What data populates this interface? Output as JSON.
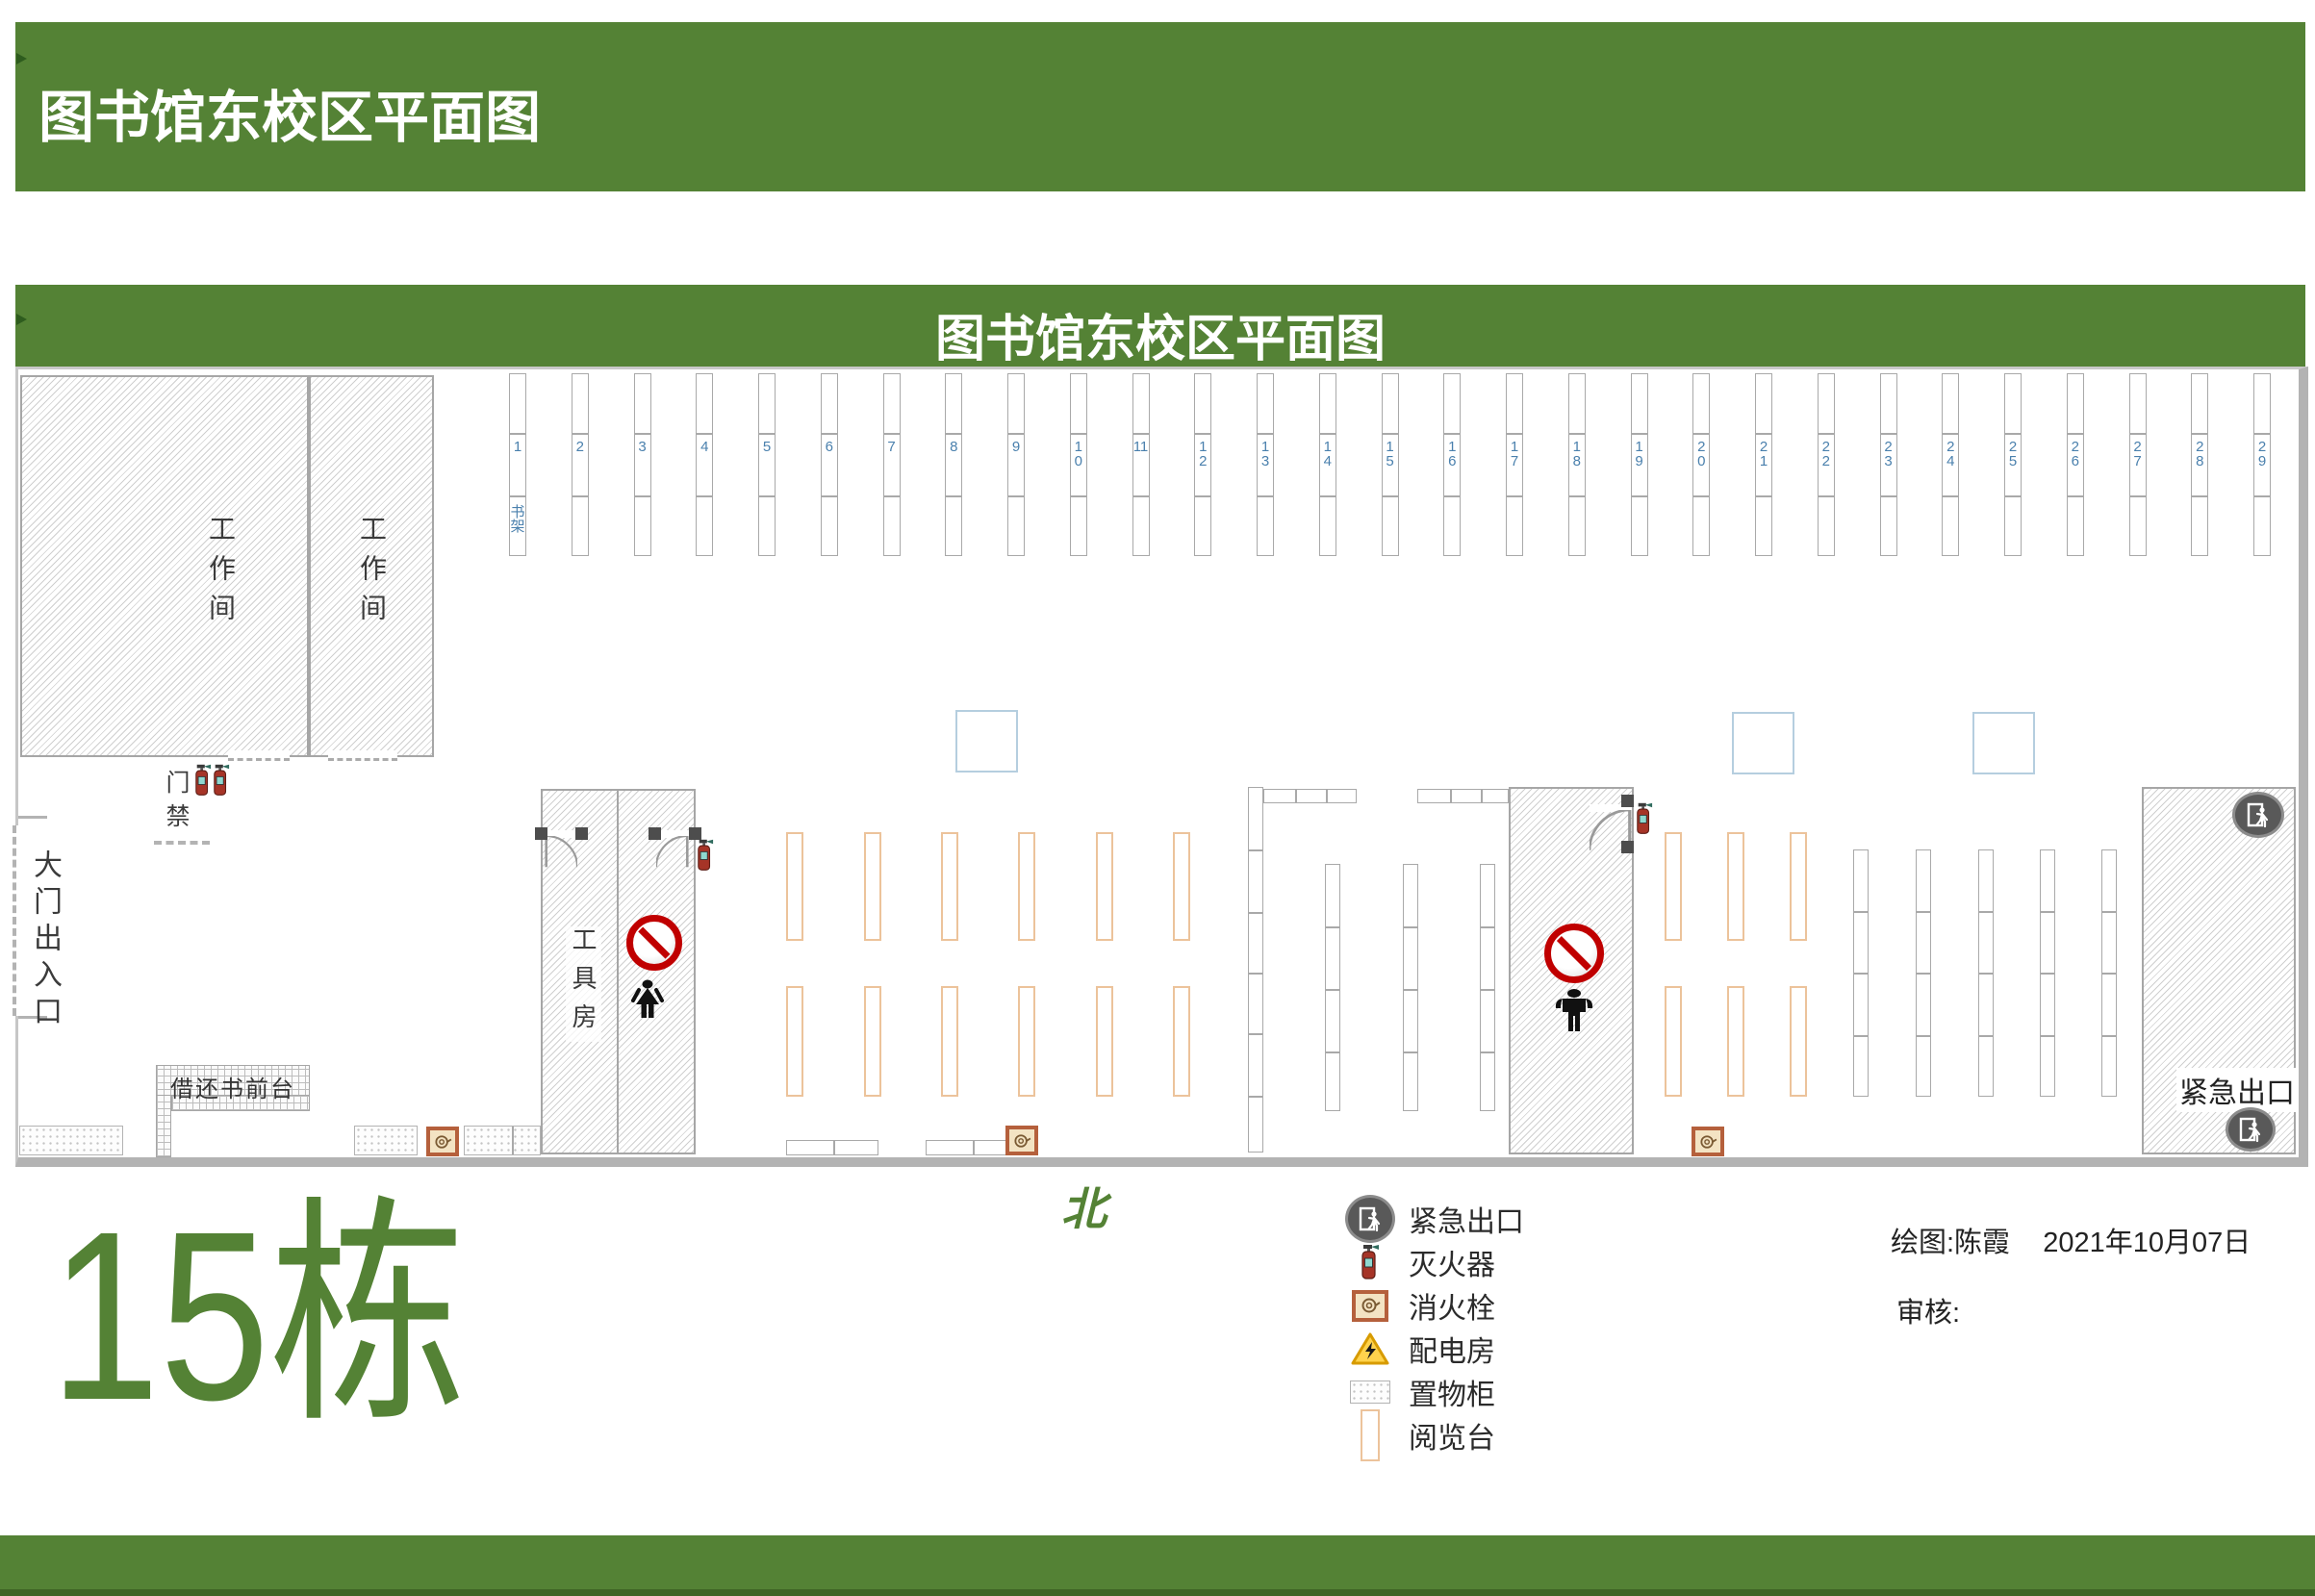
{
  "page": {
    "header_title": "图书馆东校区平面图",
    "plan_title": "图书馆东校区平面图",
    "building_label": "15栋",
    "north_label": "北"
  },
  "plan": {
    "workroom1_label": "工作间",
    "workroom2_label": "工作间",
    "tool_room_label": "工具房",
    "entrance_label": "大门出入口",
    "access_control_label": "门禁",
    "service_desk_label": "借还书前台",
    "emergency_exit_label": "紧急出口",
    "shelves": {
      "unit_label": "书架",
      "numbers": [
        "1",
        "2",
        "3",
        "4",
        "5",
        "6",
        "7",
        "8",
        "9",
        "10",
        "11",
        "12",
        "13",
        "14",
        "15",
        "16",
        "17",
        "18",
        "19",
        "20",
        "21",
        "22",
        "23",
        "24",
        "25",
        "26",
        "27",
        "28",
        "29"
      ]
    }
  },
  "legend": [
    {
      "icon": "emergency-exit-icon",
      "label": "紧急出口"
    },
    {
      "icon": "fire-extinguisher-icon",
      "label": "灭火器"
    },
    {
      "icon": "fire-hydrant-icon",
      "label": "消火栓"
    },
    {
      "icon": "power-room-warning-icon",
      "label": "配电房"
    },
    {
      "icon": "storage-locker-icon",
      "label": "置物柜"
    },
    {
      "icon": "reading-table-icon",
      "label": "阅览台"
    }
  ],
  "credits": {
    "drawn_by": "绘图:陈霞",
    "date": "2021年10月07日",
    "review": "审核:"
  },
  "colors": {
    "accent_green": "#548235",
    "shelf_number_blue": "#4a80ad",
    "prohibition_red": "#c00000",
    "reading_table_tan": "#ecc39b",
    "planning_square_blue": "#b5cedf",
    "exit_badge_gray": "#595959"
  }
}
